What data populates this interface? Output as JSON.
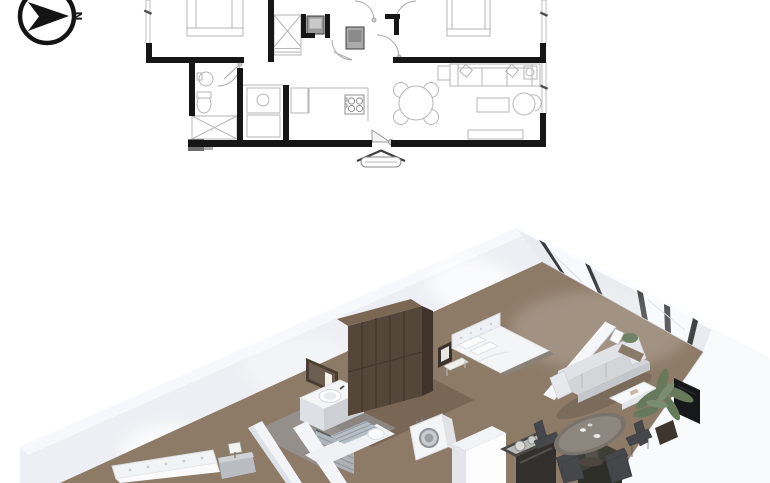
{
  "meta": {
    "kind": "apartment floor plan presentation",
    "views": [
      "2d-plan-top",
      "3d-isometric-render-bottom"
    ],
    "width_px": 770,
    "height_px": 483
  },
  "compass": {
    "label": "N",
    "direction": "arrow-points-right"
  },
  "palette": {
    "background": "#ffffff",
    "plan_wall": "#161616",
    "plan_furniture_stroke": "#b6b6b6",
    "plan_door_stroke": "#a9a9a9",
    "plan_gray_block": "#6f6f6f",
    "wall_light": "#edeff4",
    "wall_bright": "#f9fafc",
    "floor_wood": "#8d7a67",
    "floor_wood_dark": "#6e5c4b",
    "bath_tile": "#9aa1a8",
    "wood_dark": "#55463a",
    "sofa_gray": "#d3d5d9",
    "plant_green": "#66795a",
    "tv_black": "#17181a",
    "glass_blue": "#b4bcc4",
    "window_frame_dark": "#3a3b3e"
  },
  "plan2d": {
    "fixtures": [
      "bed",
      "bed",
      "wardrobe-x-closet",
      "linen-closet",
      "toilet",
      "wash-basin",
      "washer",
      "fridge",
      "oven-tower",
      "cooktop-4-burner",
      "round-dining-table",
      "sofa-3-seat",
      "armchair",
      "coffee-table",
      "tv-cabinet",
      "side-tables",
      "entrance-door",
      "entrance-canopy",
      "windows",
      "door-swings"
    ]
  },
  "render3d": {
    "furniture": [
      "tufted-bed",
      "nightstand-lamp",
      "vanity-mirror-sink",
      "glass-shower",
      "tall-wood-wardrobe",
      "double-bed-white",
      "washing-machine",
      "kitchen-range-pots",
      "kitchen-cabinet",
      "round-dining-table-chairs",
      "gray-sofa",
      "coffee-table",
      "palm-plant",
      "flat-tv",
      "window-wall"
    ]
  }
}
